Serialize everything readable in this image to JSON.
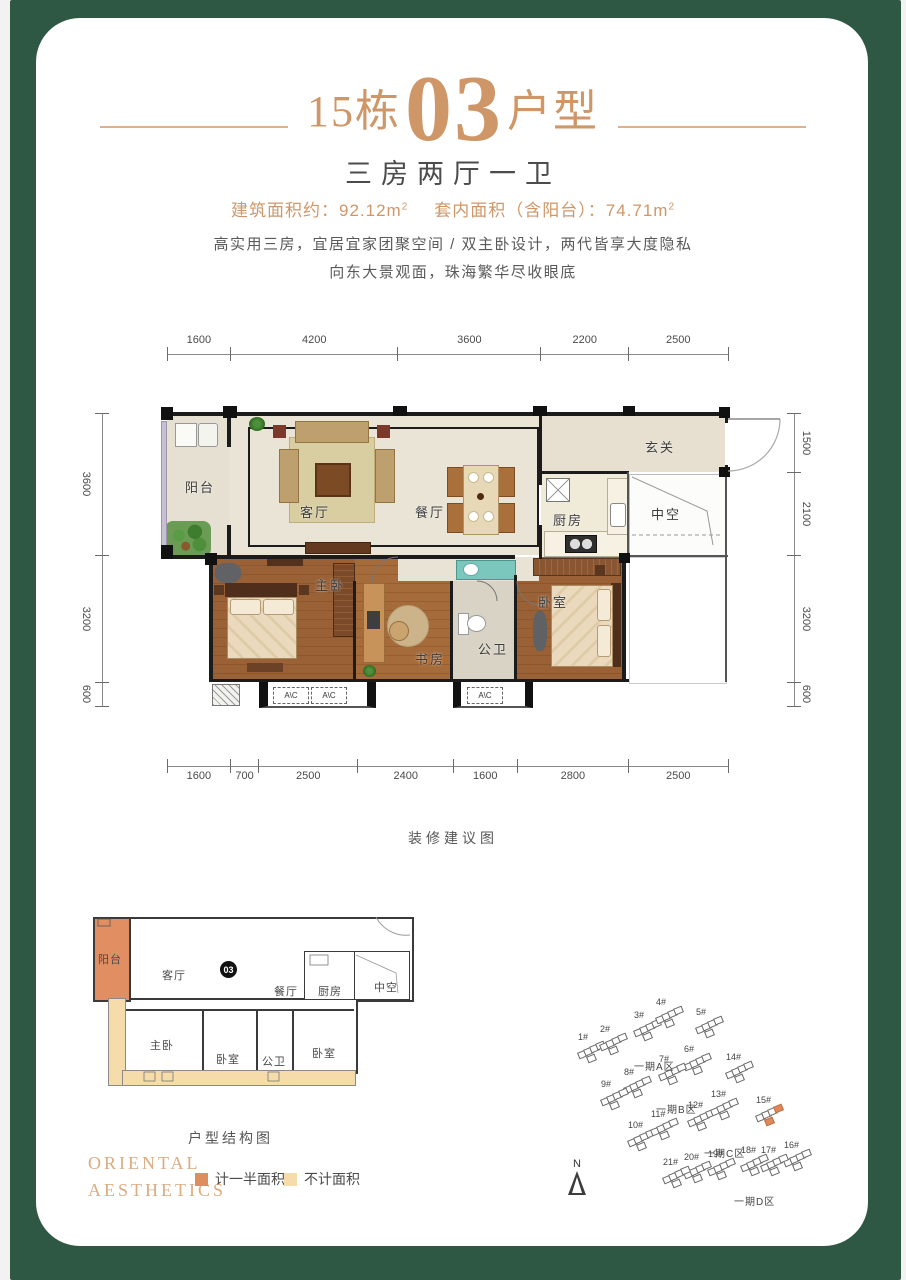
{
  "frame": {
    "color": "#2e5843"
  },
  "header": {
    "building_no": "15栋",
    "unit_no": "03",
    "unit_label": "户型",
    "subtitle": "三房两厅一卫",
    "area_build_label": "建筑面积约：",
    "area_build_value": "92.12m",
    "area_build_sup": "2",
    "area_inner_label": "套内面积（含阳台）：",
    "area_inner_value": "74.71m",
    "area_inner_sup": "2",
    "desc1": "高实用三房，宜居宜家团聚空间 / 双主卧设计，两代皆享大度隐私",
    "desc2": "向东大景观面，珠海繁华尽收眼底"
  },
  "main_plan": {
    "caption": "装修建议图",
    "ac_label": "A\\C",
    "dims": {
      "top": [
        "1600",
        "4200",
        "3600",
        "2200",
        "2500"
      ],
      "bottom": [
        "1600",
        "700",
        "2500",
        "2400",
        "1600",
        "2800",
        "2500"
      ],
      "left": [
        "3600",
        "3200",
        "600"
      ],
      "right": [
        "1500",
        "2100",
        "3200",
        "600"
      ]
    },
    "rooms": [
      {
        "name": "阳台",
        "x": 18,
        "y": 62
      },
      {
        "name": "客厅",
        "x": 133,
        "y": 87
      },
      {
        "name": "餐厅",
        "x": 248,
        "y": 87
      },
      {
        "name": "玄关",
        "x": 478,
        "y": 22
      },
      {
        "name": "厨房",
        "x": 386,
        "y": 95
      },
      {
        "name": "中空",
        "x": 484,
        "y": 89
      },
      {
        "name": "主卧",
        "x": 148,
        "y": 160
      },
      {
        "name": "书房",
        "x": 248,
        "y": 234
      },
      {
        "name": "公卫",
        "x": 311,
        "y": 224
      },
      {
        "name": "卧室",
        "x": 371,
        "y": 177
      }
    ]
  },
  "structure_plan": {
    "caption": "户型结构图",
    "unit_badge": "03",
    "rooms": [
      {
        "name": "阳台",
        "x": 8,
        "y": 48
      },
      {
        "name": "客厅",
        "x": 72,
        "y": 64
      },
      {
        "name": "餐厅",
        "x": 184,
        "y": 80
      },
      {
        "name": "厨房",
        "x": 228,
        "y": 80
      },
      {
        "name": "中空",
        "x": 284,
        "y": 76
      },
      {
        "name": "主卧",
        "x": 60,
        "y": 134
      },
      {
        "name": "卧室",
        "x": 126,
        "y": 148
      },
      {
        "name": "公卫",
        "x": 172,
        "y": 150
      },
      {
        "name": "卧室",
        "x": 222,
        "y": 142
      }
    ],
    "legend": [
      {
        "color": "#dd8e5c",
        "label": "计一半面积"
      },
      {
        "color": "#f6dcab",
        "label": "不计面积"
      }
    ]
  },
  "brand": {
    "line1": "ORIENTAL",
    "line2": "AESTHETICS"
  },
  "site_plan": {
    "north_label": "N",
    "zones": [
      {
        "label": "一期A区",
        "x": 84,
        "y": 58
      },
      {
        "label": "一期B区",
        "x": 106,
        "y": 101
      },
      {
        "label": "一期C区",
        "x": 154,
        "y": 145
      },
      {
        "label": "一期D区",
        "x": 184,
        "y": 193
      }
    ],
    "buildings": [
      {
        "id": "1#",
        "x": 28,
        "y": 42
      },
      {
        "id": "2#",
        "x": 50,
        "y": 34
      },
      {
        "id": "3#",
        "x": 84,
        "y": 20
      },
      {
        "id": "4#",
        "x": 106,
        "y": 7
      },
      {
        "id": "5#",
        "x": 146,
        "y": 17
      },
      {
        "id": "6#",
        "x": 134,
        "y": 54
      },
      {
        "id": "7#",
        "x": 109,
        "y": 64
      },
      {
        "id": "8#",
        "x": 74,
        "y": 77
      },
      {
        "id": "9#",
        "x": 51,
        "y": 89
      },
      {
        "id": "10#",
        "x": 78,
        "y": 130
      },
      {
        "id": "11#",
        "x": 101,
        "y": 119
      },
      {
        "id": "12#",
        "x": 138,
        "y": 110
      },
      {
        "id": "13#",
        "x": 161,
        "y": 99
      },
      {
        "id": "14#",
        "x": 176,
        "y": 62
      },
      {
        "id": "15#",
        "x": 206,
        "y": 105,
        "highlight": true
      },
      {
        "id": "16#",
        "x": 234,
        "y": 150
      },
      {
        "id": "17#",
        "x": 211,
        "y": 155
      },
      {
        "id": "18#",
        "x": 191,
        "y": 155
      },
      {
        "id": "19#",
        "x": 158,
        "y": 159
      },
      {
        "id": "20#",
        "x": 134,
        "y": 162
      },
      {
        "id": "21#",
        "x": 113,
        "y": 167
      }
    ]
  }
}
